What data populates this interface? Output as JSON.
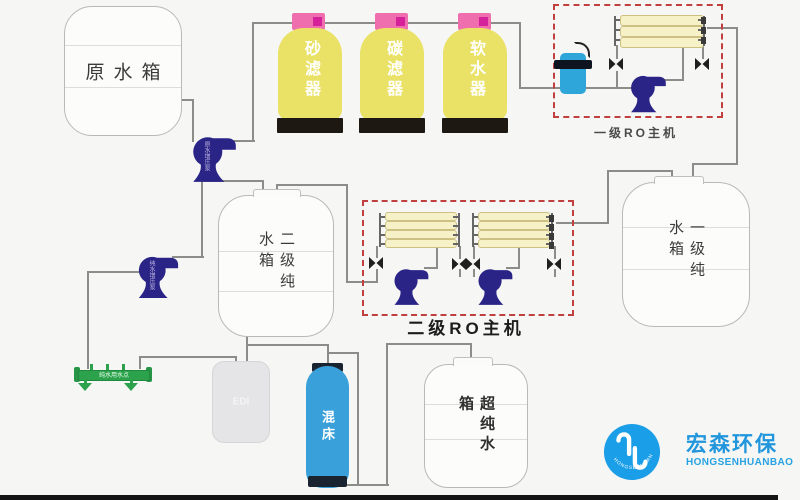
{
  "tanks": {
    "raw": {
      "label": "原水箱"
    },
    "second_pure": {
      "label": "二级纯水箱"
    },
    "first_pure": {
      "label": "一级纯水箱"
    },
    "ultra_pure": {
      "label": "超纯水箱"
    },
    "edi": {
      "label": "EDI"
    }
  },
  "filters": {
    "sand": {
      "label": "砂滤器"
    },
    "carbon": {
      "label": "碳滤器"
    },
    "softener": {
      "label": "软水器"
    }
  },
  "ro_units": {
    "stage1": {
      "label": "一级RO主机"
    },
    "stage2": {
      "label": "二级RO主机"
    }
  },
  "mixed_bed": {
    "label": "混床"
  },
  "pumps": {
    "raw_booster": {
      "label": "原水增压泵"
    },
    "pure_booster": {
      "label": "纯水增压泵"
    }
  },
  "manifold": {
    "label": "纯水用水点"
  },
  "logo": {
    "name_cn": "宏森环保",
    "name_en": "HONGSENHUANBAO",
    "ring_text": "HONGSENHUANBAO",
    "color": "#1a9ee8"
  },
  "colors": {
    "filter_body": "#e9e266",
    "filter_cap": "#f06fa8",
    "pump": "#2b2487",
    "membrane_tube": "#f6f1c6",
    "mixed_bed_body": "#3aa0d9",
    "precision_filter": "#2fa6d9",
    "manifold_green": "#2ca24c",
    "ro_box_dash": "#c04040",
    "pipe": "#8c8c88"
  }
}
